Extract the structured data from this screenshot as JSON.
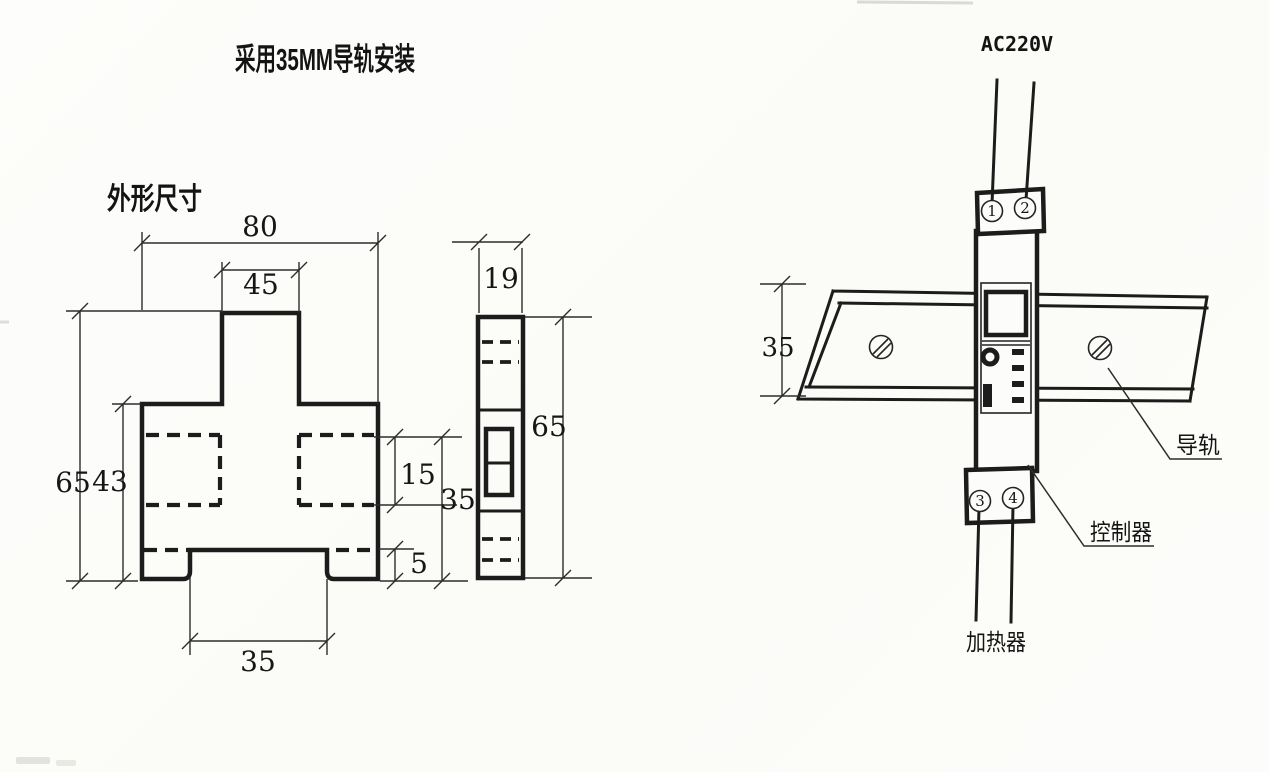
{
  "page": {
    "title": "采用35MM导轨安装"
  },
  "front_view": {
    "label": "外形尺寸",
    "dim_total_width": "80",
    "dim_neck_width": "45",
    "dim_total_height": "65",
    "dim_body_height": "43",
    "dim_clip_height": "15",
    "dim_rail_zone_height": "35",
    "dim_foot_height": "5",
    "dim_notch_width": "35"
  },
  "side_view": {
    "dim_width": "19",
    "dim_height": "65"
  },
  "install_view": {
    "power_label": "AC220V",
    "dim_rail_width": "35",
    "terminals": [
      "1",
      "2",
      "3",
      "4"
    ],
    "rail_label": "导轨",
    "controller_label": "控制器",
    "heater_label": "加热器"
  },
  "colors": {
    "ink": "#1c1c1c",
    "paper": "#fcfcfa"
  }
}
